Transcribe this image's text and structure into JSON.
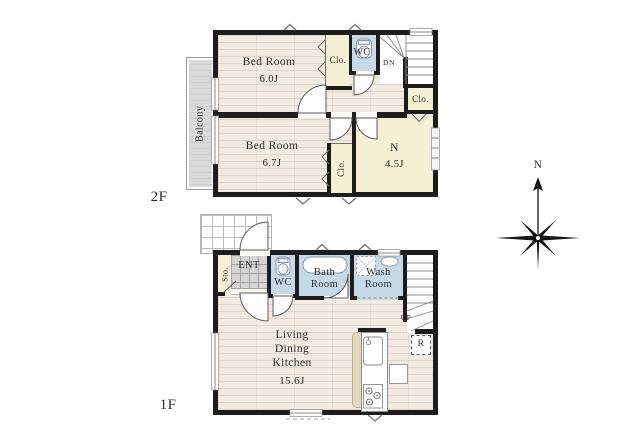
{
  "compass": {
    "north": "N"
  },
  "floor2": {
    "label": "2F",
    "balcony": "Balcony",
    "bedroom1": {
      "name": "Bed Room",
      "size": "6.0J"
    },
    "bedroom2": {
      "name": "Bed Room",
      "size": "6.7J"
    },
    "closet_top": "Clo.",
    "closet_right": "Clo.",
    "closet_bottom": "Clo.",
    "wc": "WC",
    "stairs_down": "DN",
    "n_room": {
      "name": "N",
      "size": "4.5J"
    }
  },
  "floor1": {
    "label": "1F",
    "storage": "Sto.",
    "entrance": "ENT",
    "wc": "WC",
    "bath_room": {
      "line1": "Bath",
      "line2": "Room"
    },
    "wash_room": {
      "line1": "Wash",
      "line2": "Room"
    },
    "stairs_up": "UP",
    "refrigerator": "R",
    "ldk": {
      "line1": "Living",
      "line2": "Dining",
      "line3": "Kitchen",
      "size": "15.6J"
    }
  },
  "colors": {
    "wall": "#1d1d1d",
    "wood": "#f0eae0",
    "cream": "#f3f0d4",
    "wet": "#c7d8e7",
    "balcony": "#d9d9d9",
    "tile": "#d4d4d4",
    "ink": "#2f2f2f"
  }
}
